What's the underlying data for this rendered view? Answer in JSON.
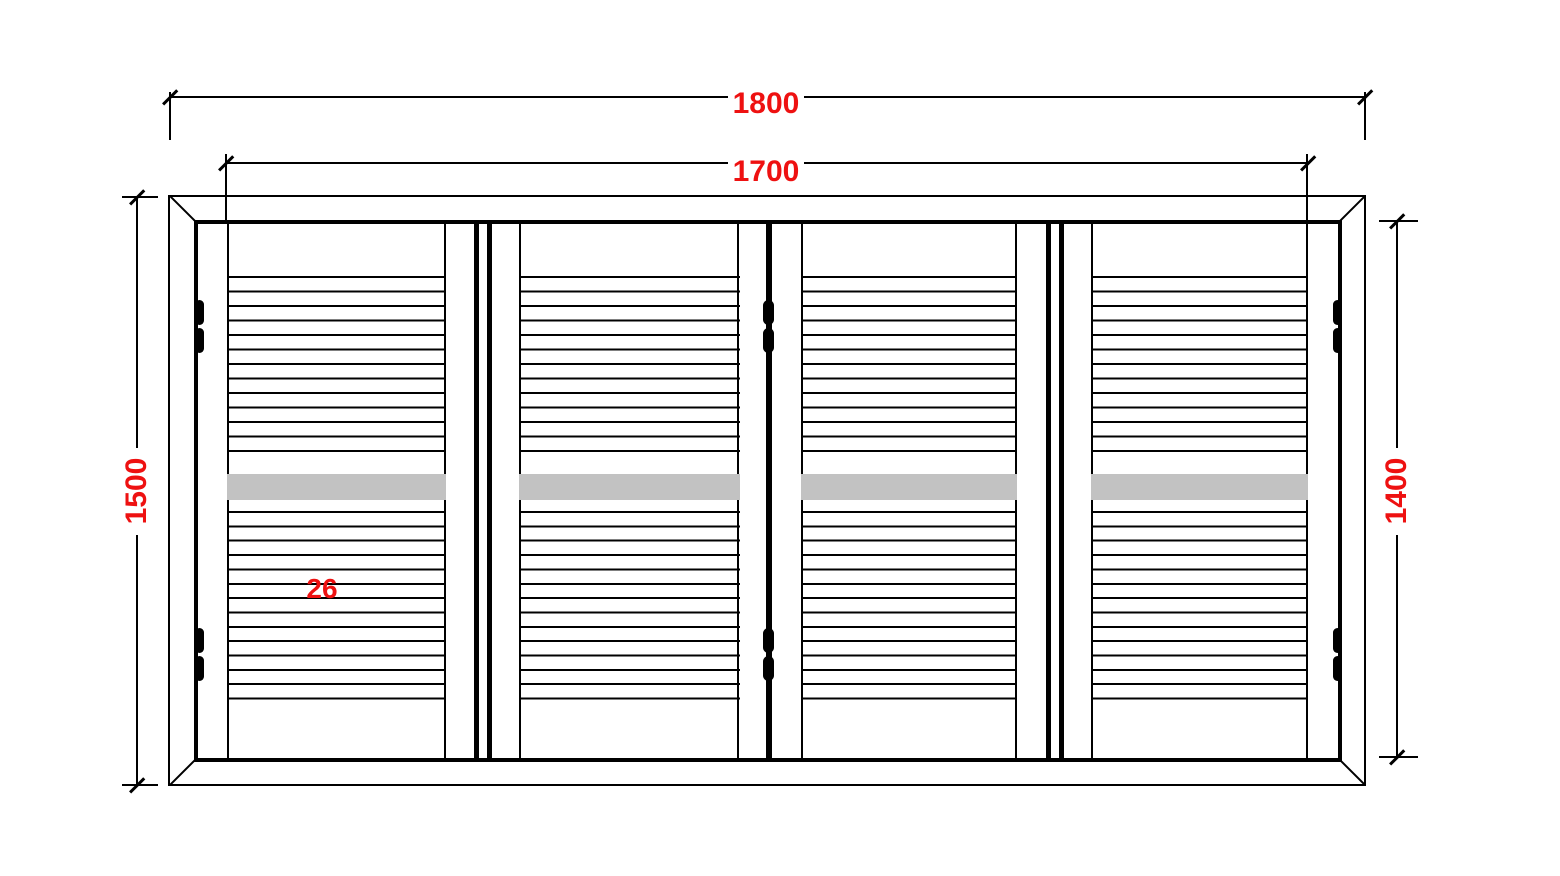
{
  "drawing": {
    "type": "shutter-elevation-diagram",
    "dimensions": [
      {
        "id": "overall-width",
        "label": "1800",
        "orientation": "horizontal"
      },
      {
        "id": "opening-width",
        "label": "1700",
        "orientation": "horizontal"
      },
      {
        "id": "overall-height",
        "label": "1500",
        "orientation": "vertical"
      },
      {
        "id": "opening-height",
        "label": "1400",
        "orientation": "vertical"
      },
      {
        "id": "slat-size",
        "label": "26",
        "orientation": "none"
      }
    ],
    "colors": {
      "dimension_text": "#ee1111",
      "lines": "#000000",
      "mid_rail_highlight": "#c2c2c2",
      "background": "#ffffff"
    },
    "panel_count": 4,
    "hinge_count": 6,
    "louver_rows_per_panel": 27
  }
}
